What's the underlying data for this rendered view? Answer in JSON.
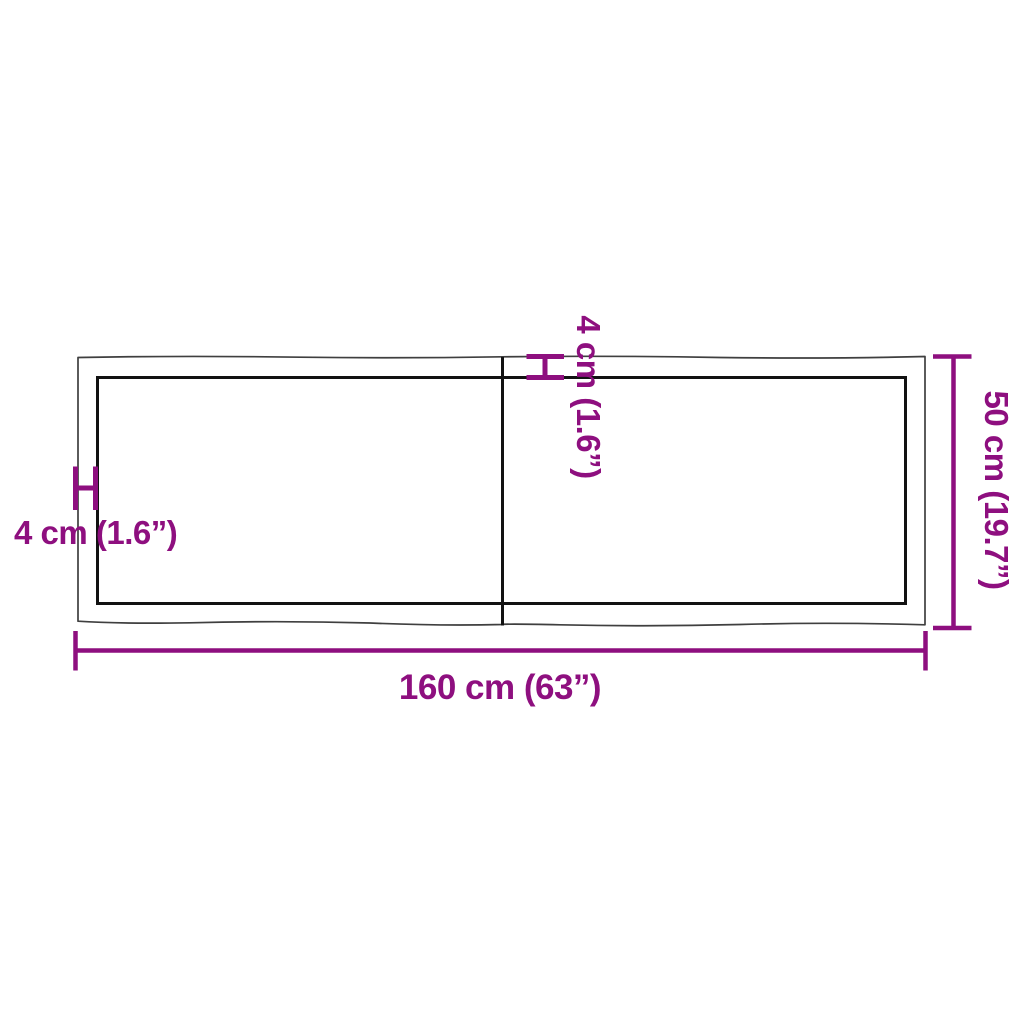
{
  "diagram": {
    "type": "product-dimension-diagram",
    "subject": "two-piece rectangular table top, top view",
    "labels": {
      "width": "160 cm (63”)",
      "height": "50 cm (19.7”)",
      "thickness_left": "4 cm (1.6”)",
      "thickness_top": "4 cm (1.6”)"
    }
  },
  "colors": {
    "dimension": "#8e0f7f",
    "outline": "#3f3f3f",
    "edge": "#121212",
    "background": "#ffffff"
  }
}
